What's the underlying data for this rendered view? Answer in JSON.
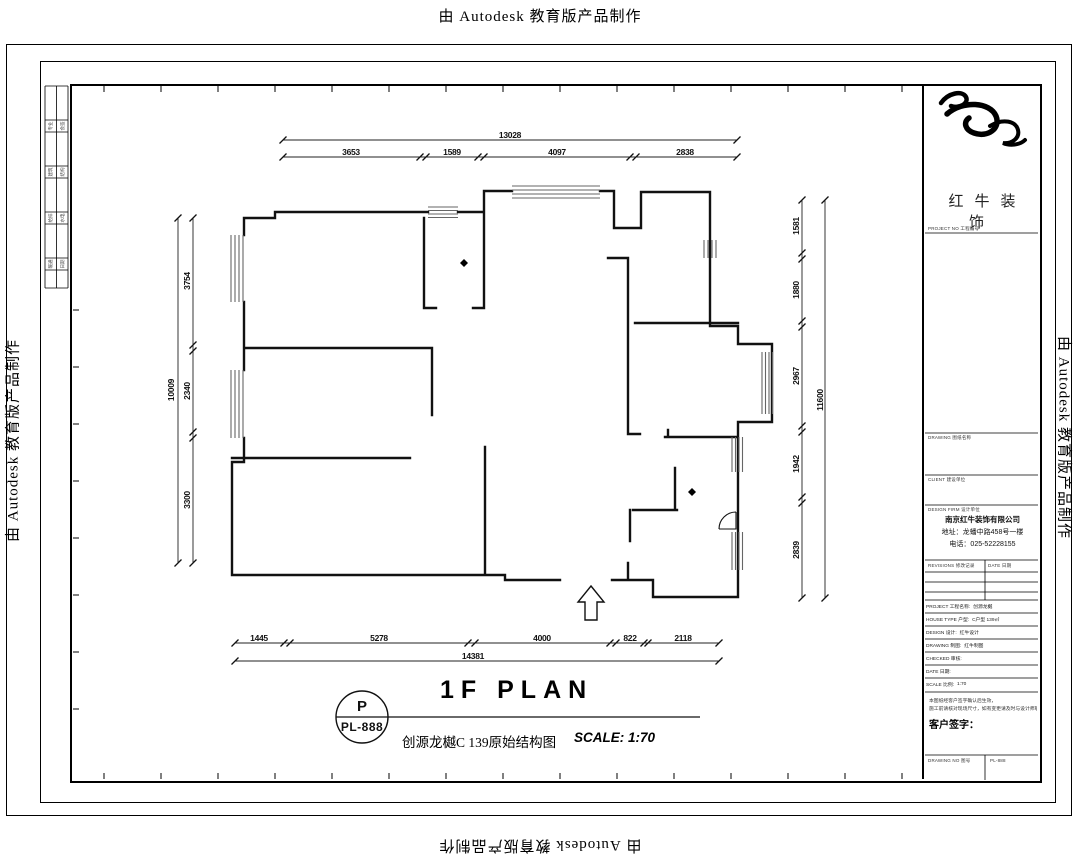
{
  "watermarks": {
    "top": "由 Autodesk 教育版产品制作",
    "bottom": "由 Autodesk 教育版产品制作",
    "left": "由 Autodesk 教育版产品制作",
    "right": "由 Autodesk 教育版产品制作"
  },
  "plan_label": {
    "title": "1F PLAN",
    "tag_letter": "P",
    "tag_number": "PL-888",
    "drawing_name": "创源龙樾C 139原始结构图",
    "scale": "SCALE: 1:70"
  },
  "dimensions": {
    "top": {
      "total": "13028",
      "segments": [
        "3653",
        "1589",
        "4097",
        "2838"
      ]
    },
    "bottom": {
      "total": "14381",
      "segments": [
        "1445",
        "5278",
        "4000",
        "822",
        "2118"
      ]
    },
    "left": {
      "total": "10009",
      "segments": [
        "3754",
        "2340",
        "3300"
      ]
    },
    "right": {
      "total": "11600",
      "segments": [
        "1581",
        "1880",
        "2967",
        "1942",
        "2839"
      ]
    }
  },
  "titleblock": {
    "brand": "红牛装饰",
    "section_labels": {
      "project_no": "PROJECT NO 工程编号",
      "drawing_list": "DRAWING 图纸名称",
      "client": "CLIENT 建设单位",
      "design_firm": "DESIGN FIRM 设计单位",
      "revisions": "REVISIONS 修改记录",
      "rev_date": "DATE 日期"
    },
    "company": {
      "name": "南京红牛装饰有限公司",
      "address": "地址：龙蟠中路458号一楼",
      "phone": "电话：025-52228155"
    },
    "fields": [
      {
        "label": "PROJECT 工程名称:",
        "value": "创源龙樾"
      },
      {
        "label": "HOUSE TYPE 户型:",
        "value": "C户型 139㎡"
      },
      {
        "label": "DESIGN 设计:",
        "value": "红牛设计"
      },
      {
        "label": "DRAWING 制图:",
        "value": "红牛制图"
      },
      {
        "label": "CHECKED 审核:",
        "value": ""
      },
      {
        "label": "DATE 日期:",
        "value": ""
      },
      {
        "label": "SCALE 比例:",
        "value": "1:70"
      }
    ],
    "notes": [
      "本图纸经客户签字确认后生效，",
      "施工前请核对现场尺寸，如有变更请及时与设计师联系。"
    ],
    "signature_label": "客户签字：",
    "footer": {
      "left": "DRAWING NO 图号",
      "right": "PL-888"
    }
  },
  "signoff": {
    "rows": [
      {
        "left": "专业",
        "right": "会签"
      },
      {
        "left": "建筑",
        "right": "结构"
      },
      {
        "left": "给排",
        "right": "水电"
      },
      {
        "left": "暖通",
        "right": "日期"
      }
    ]
  }
}
